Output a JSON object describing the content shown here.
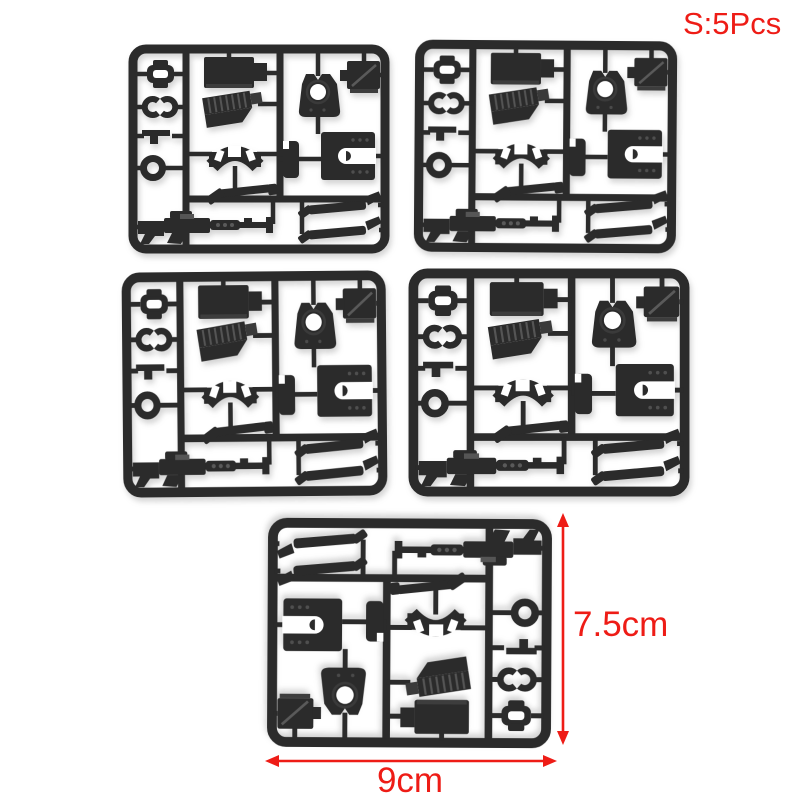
{
  "photo": {
    "subject": "Five black plastic model-kit parts sprues on a white background",
    "sprue_count": 5
  },
  "annotations": {
    "quantity_label": "S:5Pcs",
    "height_label": "7.5cm",
    "width_label": "9cm"
  },
  "colors": {
    "annotation_red": "#ee1c16",
    "plastic": "#2b2b2b",
    "background": "#ffffff"
  },
  "sprues": [
    {
      "position": "top-left"
    },
    {
      "position": "top-right"
    },
    {
      "position": "middle-left"
    },
    {
      "position": "middle-right"
    },
    {
      "position": "bottom-center",
      "rotation": "180deg"
    }
  ]
}
